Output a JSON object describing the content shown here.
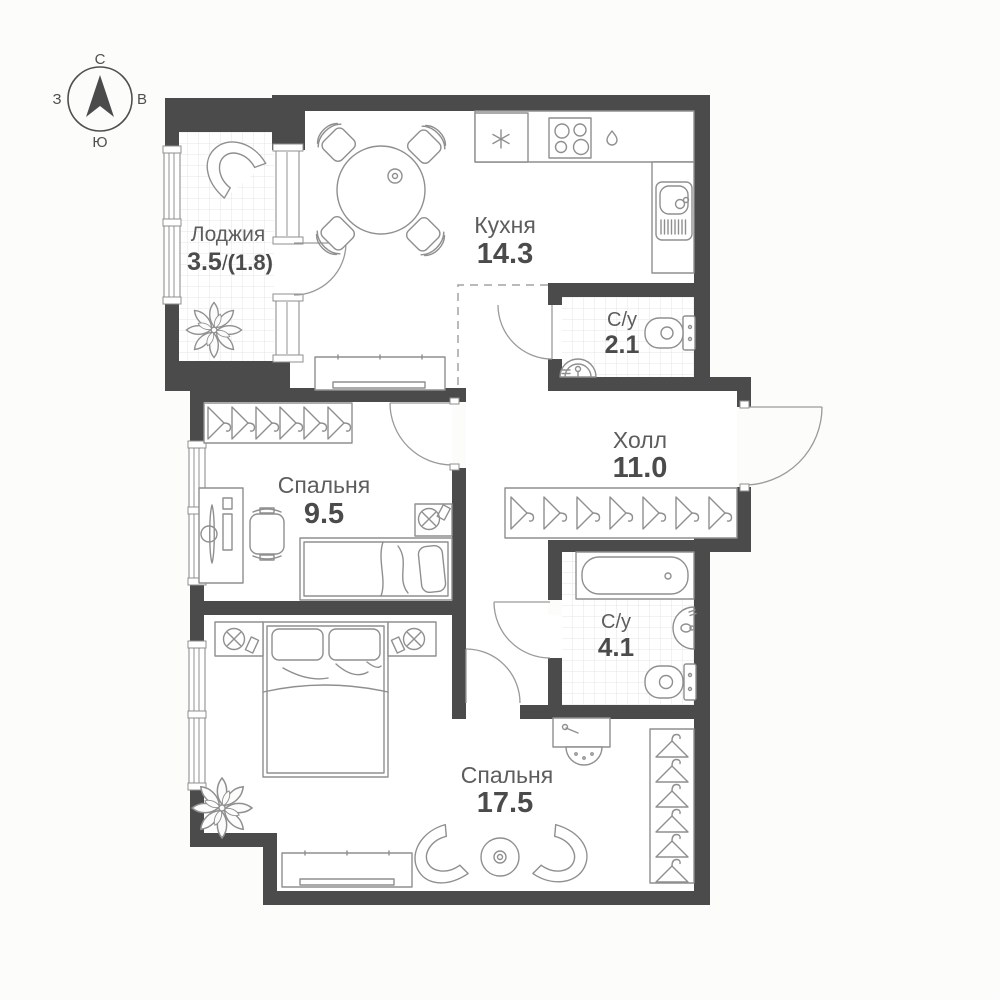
{
  "title": "Планировка квартиры",
  "compass": {
    "north": "С",
    "east": "В",
    "south": "Ю",
    "west": "З"
  },
  "rooms": {
    "loggia": {
      "name": "Лоджия",
      "area_main": "3.5",
      "area_sep": "/",
      "area_reduced": "(1.8)"
    },
    "kitchen": {
      "name": "Кухня",
      "area": "14.3"
    },
    "wc_small": {
      "name": "С/у",
      "area": "2.1"
    },
    "hall": {
      "name": "Холл",
      "area": "11.0"
    },
    "bedroom_small": {
      "name": "Спальня",
      "area": "9.5"
    },
    "wc_big": {
      "name": "С/у",
      "area": "4.1"
    },
    "bedroom_big": {
      "name": "Спальня",
      "area": "17.5"
    }
  },
  "icons": [
    "compass-icon",
    "fridge-icon",
    "stove-icon",
    "droplet-icon",
    "sink-icon",
    "toilet-icon",
    "washbasin-icon",
    "bathtub-icon",
    "hanger-icon",
    "lamp-icon",
    "plant-icon",
    "armchair-icon",
    "dining-table-icon",
    "chair-icon",
    "bed-icon",
    "desk-icon",
    "tv-icon",
    "door-arc",
    "window"
  ],
  "colors": {
    "wall": "#4b4b4b",
    "furniture_line": "#8f8f8f",
    "label_text": "#5d5d5d",
    "number_text": "#4b4b4b",
    "tile_line": "#e6e6e3",
    "background": "#fcfcfb"
  }
}
